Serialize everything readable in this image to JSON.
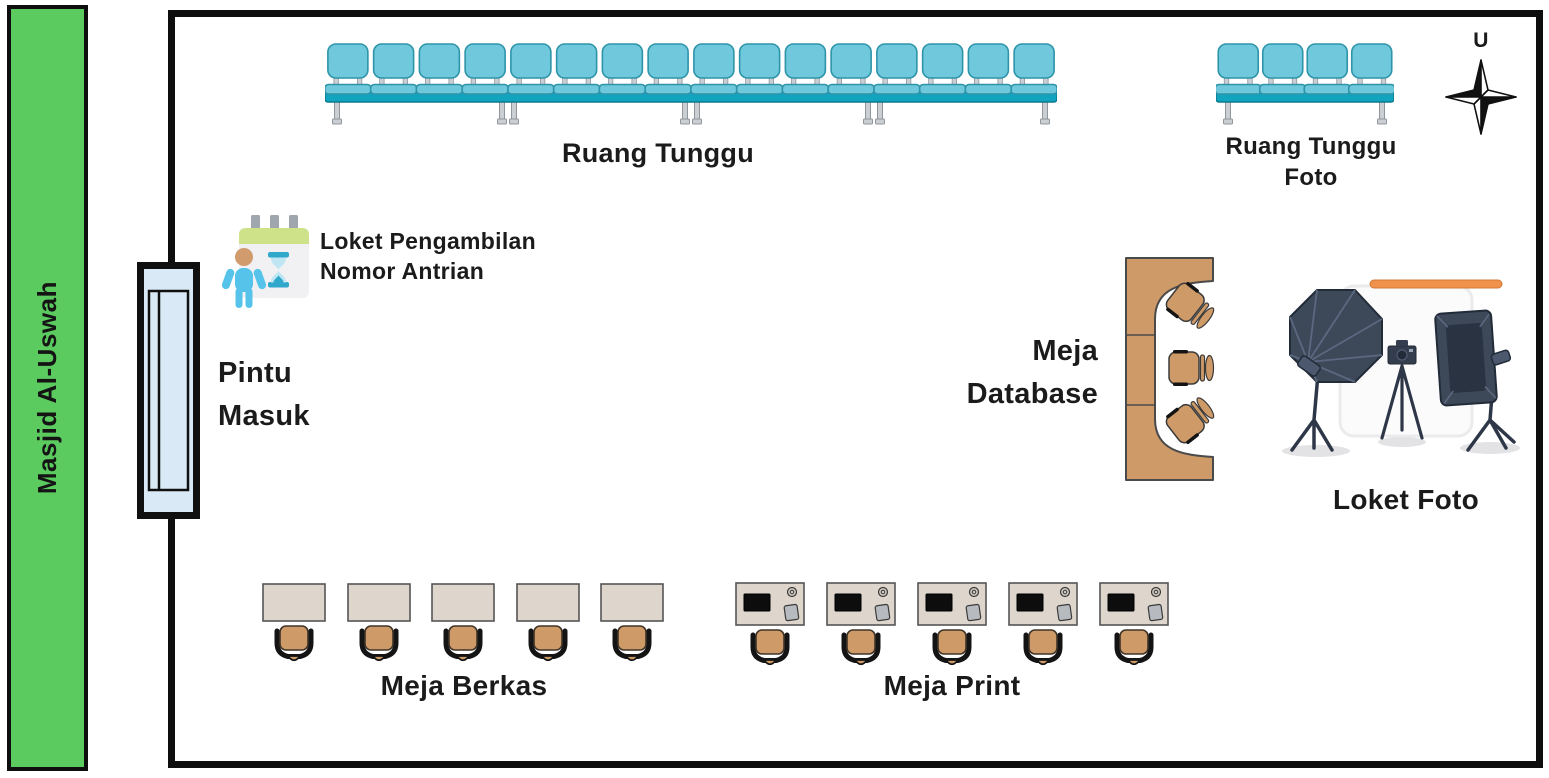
{
  "colors": {
    "green_bar": "#5BCB5F",
    "teal_seat": "#6FC8DB",
    "teal_rail": "#12A3BE",
    "door_blue": "#D9EAF6",
    "desk_beige": "#DED6CC",
    "tan": "#CE9B68",
    "studio_dark": "#3D4859",
    "orange_rail": "#F0924C",
    "text": "#1B1B1B"
  },
  "icons": {
    "compass": "compass-rose-icon",
    "queue": "queue-number-icon",
    "door": "entrance-door-icon",
    "bench": "waiting-bench-icon",
    "desk_chair": "desk-chair-icon",
    "print_station": "print-station-icon",
    "database_desk": "database-desk-icon",
    "photo_studio": "photo-studio-icon"
  },
  "masjid": {
    "label": "Masjid Al-Uswah"
  },
  "compass": {
    "north_label": "U"
  },
  "areas": {
    "ruang_tunggu": {
      "label": "Ruang Tunggu",
      "seats": 16,
      "units": 4
    },
    "ruang_tunggu_foto": {
      "label_lines": [
        "Ruang Tunggu",
        "Foto"
      ],
      "seats": 4,
      "units": 1
    },
    "loket_antrian": {
      "label_lines": [
        "Loket Pengambilan",
        "Nomor Antrian"
      ]
    },
    "pintu_masuk": {
      "label_lines": [
        "Pintu",
        "Masuk"
      ]
    },
    "meja_database": {
      "label_lines": [
        "Meja",
        "Database"
      ],
      "chairs": 3
    },
    "loket_foto": {
      "label": "Loket Foto"
    },
    "meja_berkas": {
      "label": "Meja Berkas",
      "desks": 5
    },
    "meja_print": {
      "label": "Meja Print",
      "desks": 5
    }
  }
}
